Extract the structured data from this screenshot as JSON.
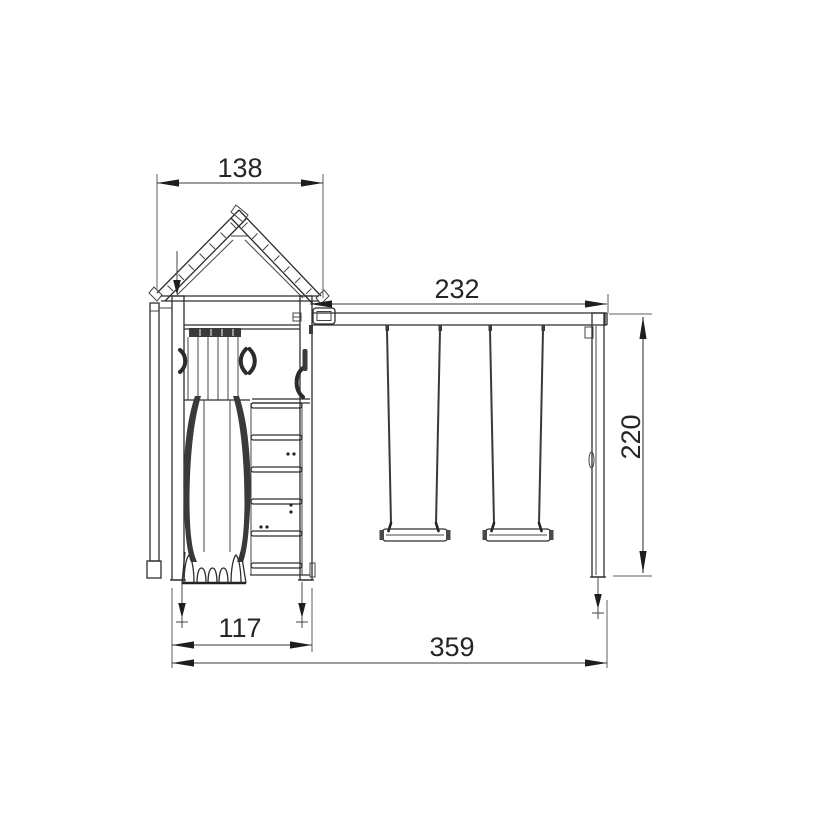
{
  "diagram": {
    "type": "technical-dimension-drawing",
    "subject": "playground-swing-set-front-elevation",
    "background_color": "#ffffff",
    "line_color": "#2e2e2e",
    "dimensions": {
      "tower_width": "138",
      "beam_length": "232",
      "post_height": "220",
      "tower_depth": "117",
      "total_length": "359"
    }
  }
}
